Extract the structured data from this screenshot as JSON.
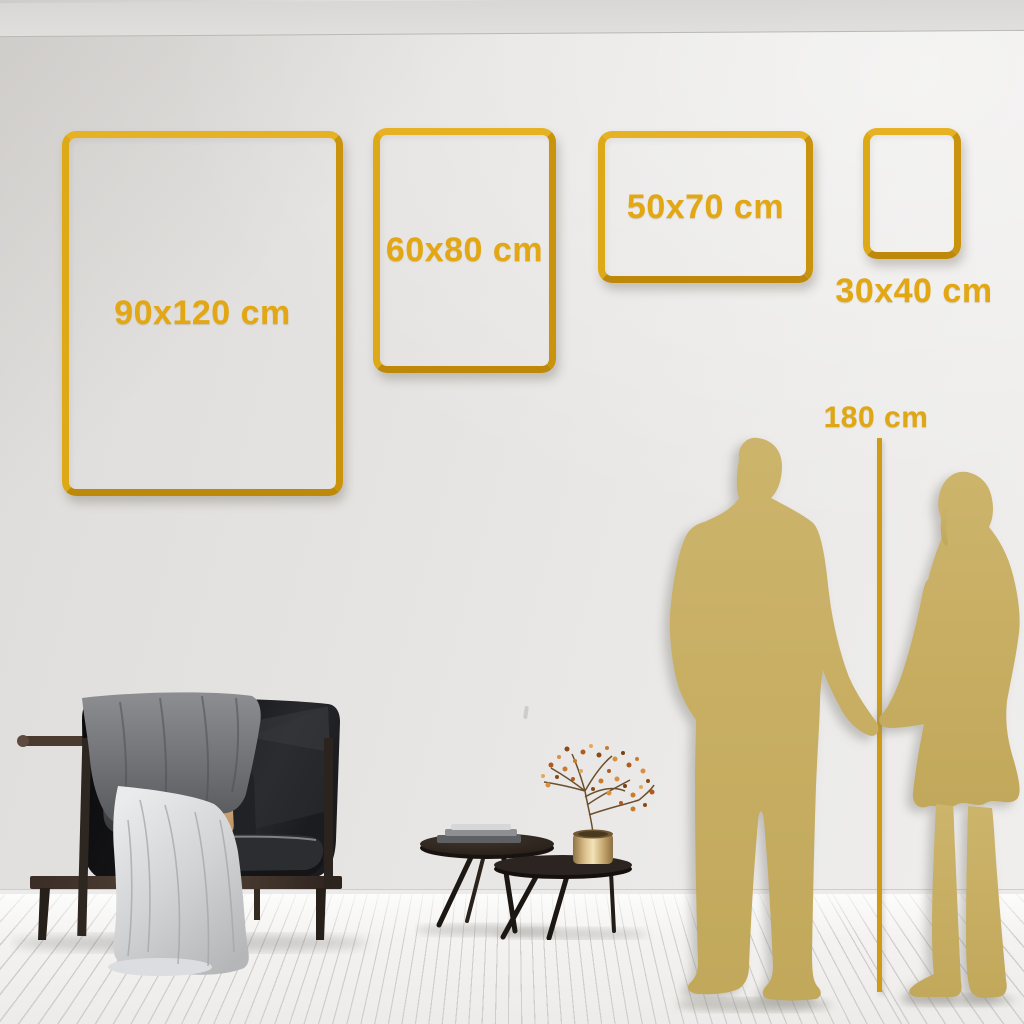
{
  "size_guide": {
    "frames": [
      {
        "size": "90x120 cm"
      },
      {
        "size": "60x80 cm"
      },
      {
        "size": "50x70 cm"
      },
      {
        "size": "30x40 cm"
      }
    ],
    "height_reference": {
      "label": "180 cm"
    }
  },
  "colors": {
    "accent_gold": "#DFA713",
    "frame_gold": "#D9A311",
    "silhouette_gold": "#C8AF63",
    "wall": "#E6E4E2",
    "floor": "#F3F2F0"
  }
}
